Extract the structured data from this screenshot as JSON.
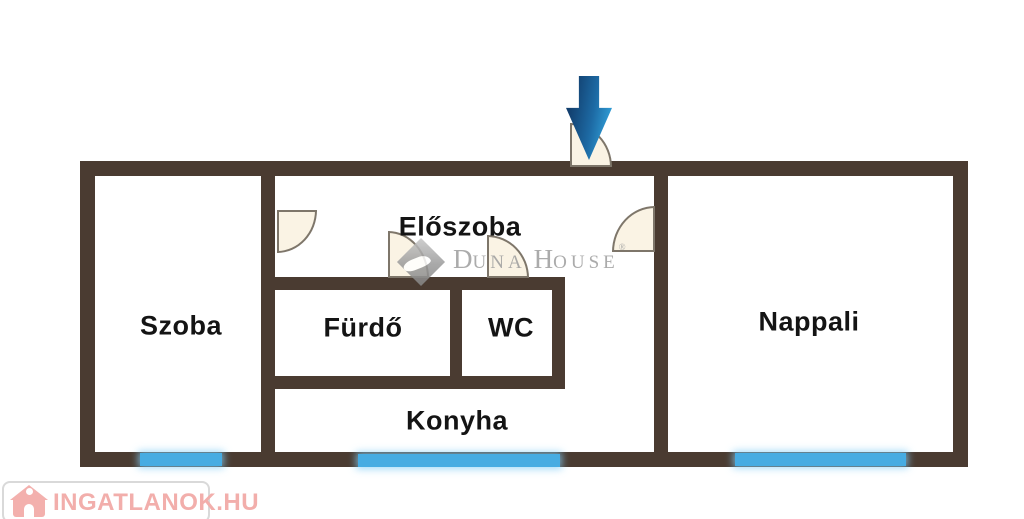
{
  "plan": {
    "rooms": {
      "eloszoba": "Előszoba",
      "szoba": "Szoba",
      "furdo": "Fürdő",
      "wc": "WC",
      "nappali": "Nappali",
      "konyha": "Konyha"
    },
    "colors": {
      "wall": "#4a3b31",
      "window": "#47ace2",
      "door_fill": "#faf3e4",
      "door_stroke": "#7e766a",
      "arrow_dark": "#123f6e",
      "arrow_light": "#2f9bd4"
    }
  },
  "watermark": {
    "d": "D",
    "una": "UNA",
    "h": "H",
    "ouse": "OUSE",
    "reg": "®",
    "color": "#9d9d9d"
  },
  "logo": {
    "text": "INGATLANOK.HU",
    "color": "#f2aeab"
  }
}
